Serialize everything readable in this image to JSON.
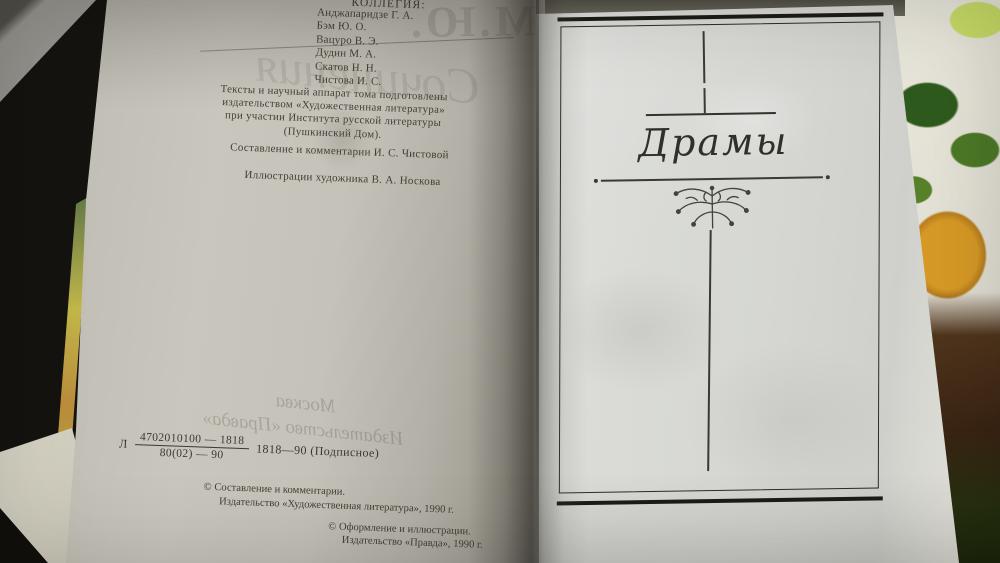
{
  "left_page": {
    "editorial_heading": "КОЛЛЕГИЯ:",
    "editorial_board": [
      "Анджапаридзе Г. А.",
      "Бэм Ю. О.",
      "Вацуро В. Э.",
      "Дудин М. А.",
      "Скатов Н. Н.",
      "Чистова И. С."
    ],
    "preparation_note_lines": [
      "Тексты и научный аппарат тома подготовлены",
      "издательством «Художественная литература»",
      "при участии Института русской литературы",
      "(Пушкинский Дом)."
    ],
    "compiler_line": "Составление и комментарии И. С. Чистовой",
    "illustrator_line": "Иллюстрации художника В. А. Носкова",
    "imprint": {
      "prefix": "Л",
      "numerator": "4702010100 — 1818",
      "denominator": "80(02) — 90",
      "suffix": "1818—90 (Подписное)"
    },
    "copyright_hudlit_line1": "© Составление и комментарии.",
    "copyright_hudlit_line2": "Издательство «Художественная литература», 1990 г.",
    "copyright_pravda_line1": "© Оформление и иллюстрации.",
    "copyright_pravda_line2": "Издательство «Правда», 1990 г.",
    "showthrough": {
      "monogram": "М.Ю.",
      "script_word": "Сочинения",
      "bottom_line1": "Москва",
      "bottom_line2": "Издательство «Правда»"
    }
  },
  "right_page": {
    "section_title": "Драмы"
  },
  "colors": {
    "left_paper": "#c9c6bd",
    "right_paper": "#dcddd9",
    "ink": "#3c3831",
    "frame_ink": "#2c2b27",
    "background_dark": "#14130f",
    "cloth_orange": "#d79a25",
    "cloth_green": "#2e5b1d"
  }
}
